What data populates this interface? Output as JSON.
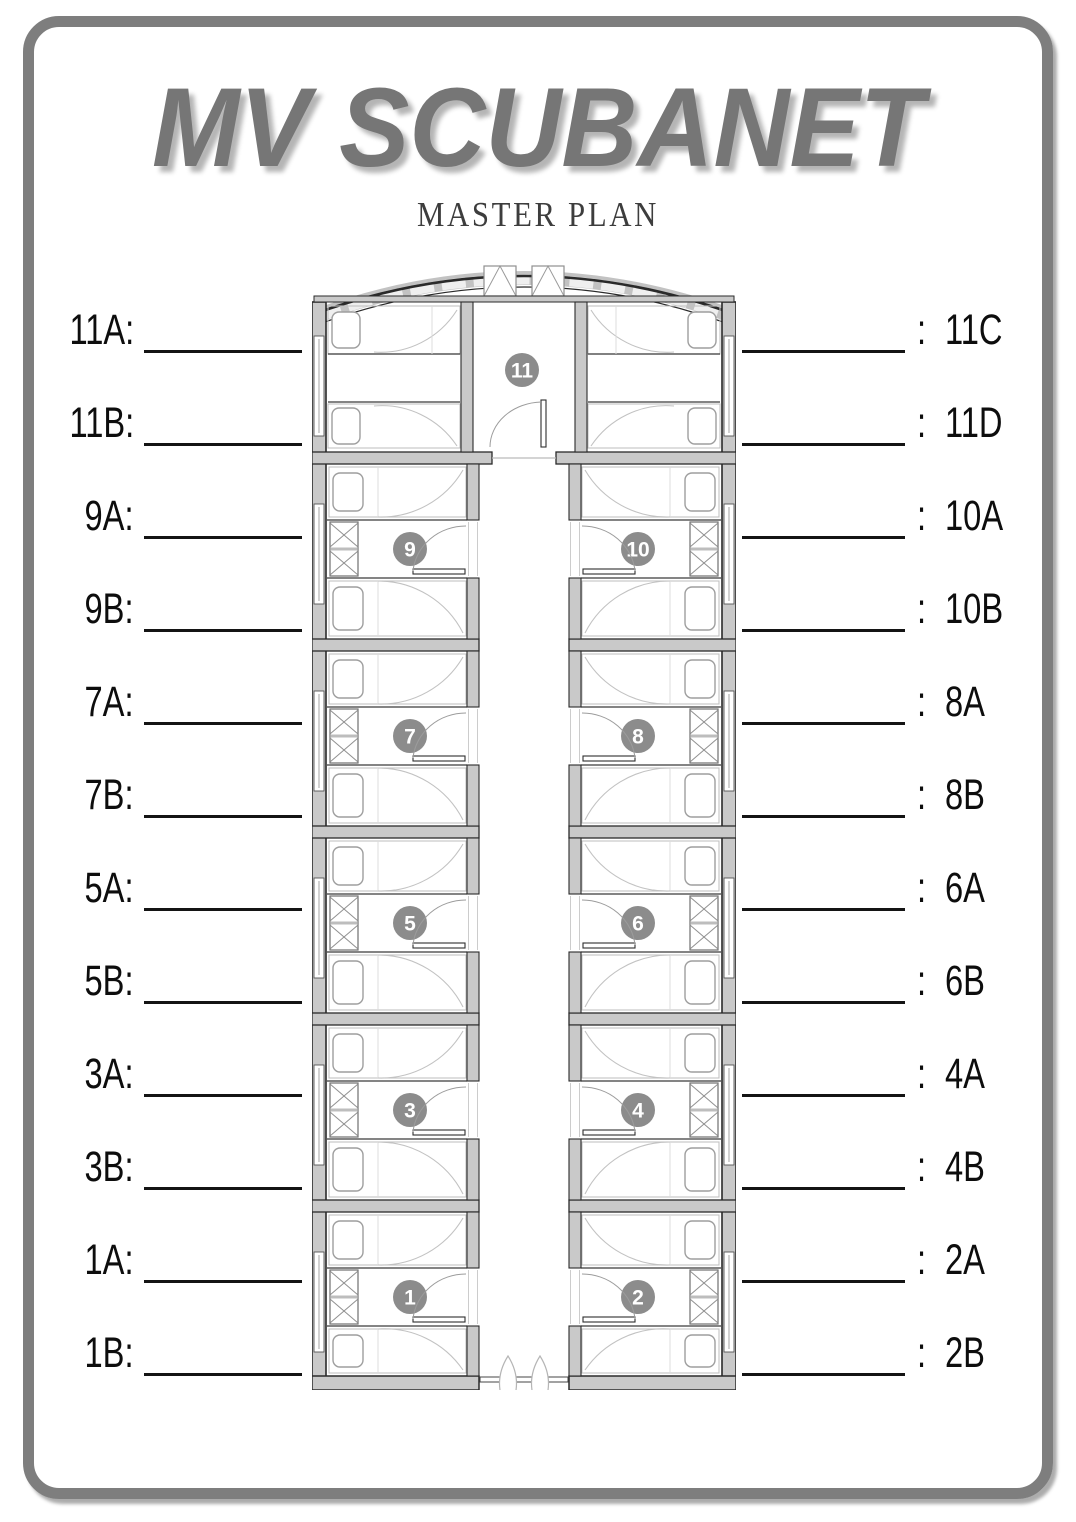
{
  "title": "MV SCUBANET",
  "subtitle": "MASTER PLAN",
  "assignments": {
    "separator": ":",
    "blank_value": "",
    "rows": [
      {
        "left": "11A",
        "right": "11C"
      },
      {
        "left": "11B",
        "right": "11D"
      },
      {
        "left": "9A",
        "right": "10A"
      },
      {
        "left": "9B",
        "right": "10B"
      },
      {
        "left": "7A",
        "right": "8A"
      },
      {
        "left": "7B",
        "right": "8B"
      },
      {
        "left": "5A",
        "right": "6A"
      },
      {
        "left": "5B",
        "right": "6B"
      },
      {
        "left": "3A",
        "right": "4A"
      },
      {
        "left": "3B",
        "right": "4B"
      },
      {
        "left": "1A",
        "right": "2A"
      },
      {
        "left": "1B",
        "right": "2B"
      }
    ]
  },
  "plan": {
    "bow_cabin": "11",
    "left_column_cabins": [
      "9",
      "7",
      "5",
      "3",
      "1"
    ],
    "right_column_cabins": [
      "10",
      "8",
      "6",
      "4",
      "2"
    ]
  },
  "colors": {
    "title_gray": "#767676",
    "title_shadow": "#b5b5b5",
    "subtitle_gray": "#3d3d3d",
    "page_border_gray": "#7e7e7e",
    "wall_fill": "#c9c9c9",
    "wall_outline": "#2a2a2a",
    "cabin_badge": "#8c8c8c",
    "badge_number": "#ffffff",
    "furniture_line": "#c2c2c2",
    "blank_line": "#141414"
  }
}
